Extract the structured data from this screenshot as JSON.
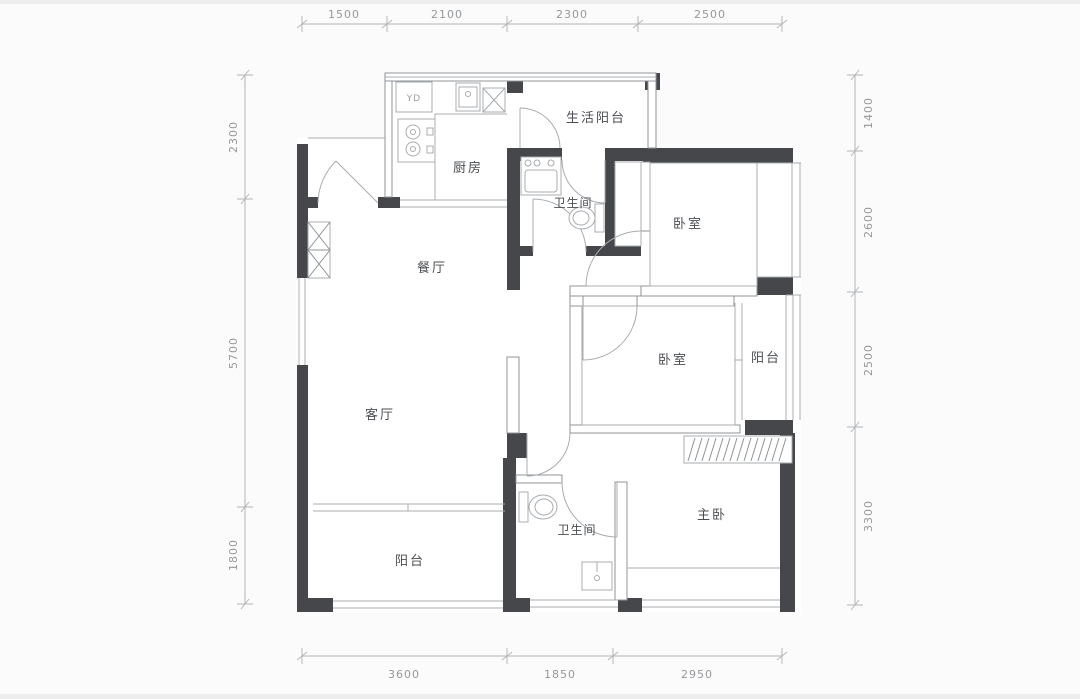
{
  "dims": {
    "top": [
      "1500",
      "2100",
      "2300",
      "2500"
    ],
    "left": [
      "2300",
      "5700",
      "1800"
    ],
    "right": [
      "1400",
      "2600",
      "2500",
      "3300"
    ],
    "bottom": [
      "3600",
      "1850",
      "2950"
    ]
  },
  "rooms": {
    "life_balcony": "生活阳台",
    "kitchen": "厨房",
    "bath_top": "卫生间",
    "bedroom_top": "卧室",
    "dining": "餐厅",
    "bedroom_mid": "卧室",
    "balcony_right": "阳台",
    "living": "客厅",
    "master": "主卧",
    "bath_bottom": "卫生间",
    "balcony_bottom": "阳台"
  },
  "labels": {
    "washer": "YD"
  },
  "colors": {
    "wall": "#45474b",
    "wline": "#8f9397",
    "line": "#a8acb0",
    "dim_line": "#b3b6b9",
    "dim_text": "#95989b",
    "room_text": "#4b4e52",
    "bg": "#fbfbfb"
  }
}
